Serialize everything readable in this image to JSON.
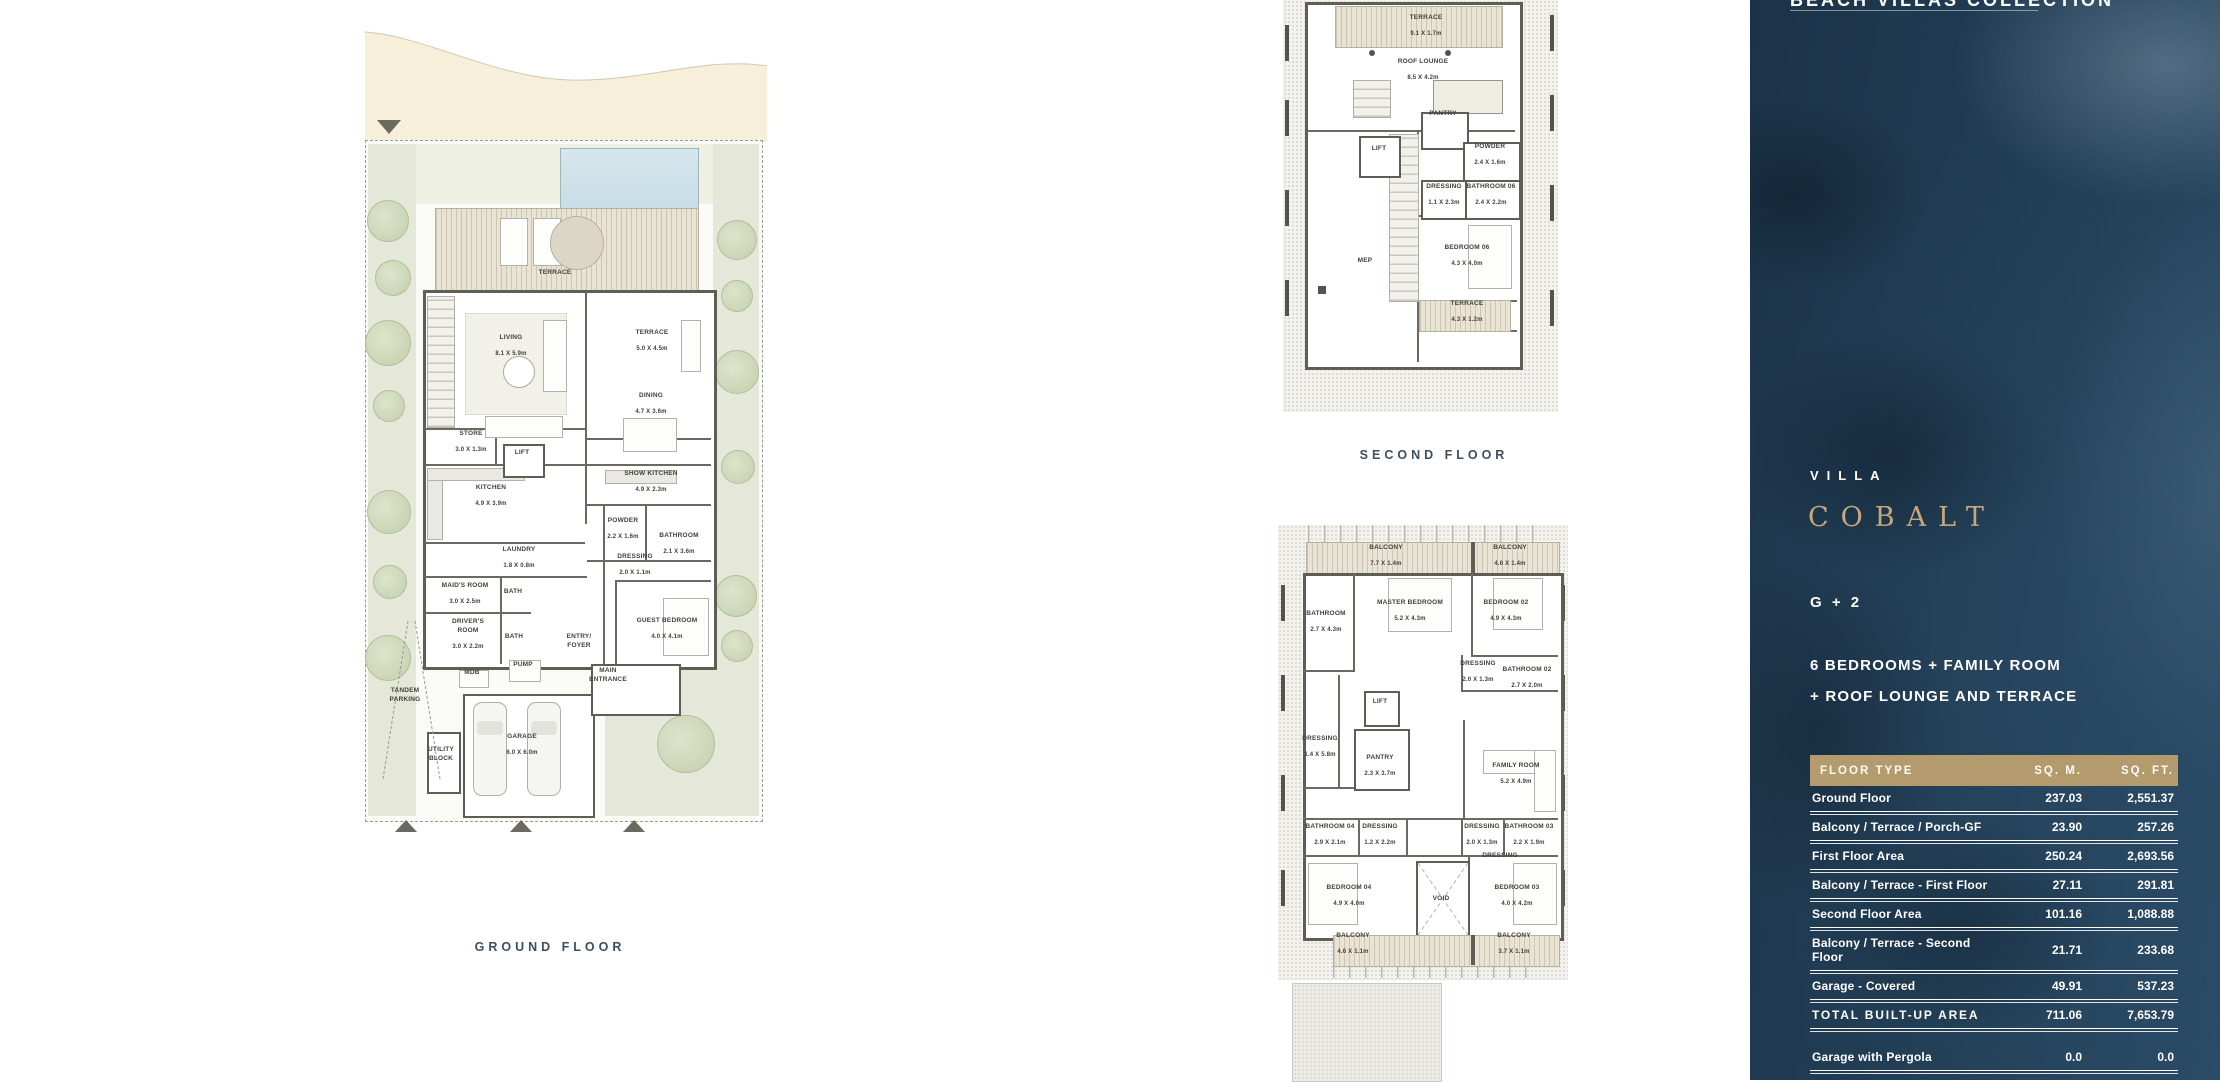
{
  "sidebar": {
    "header": "BEACH VILLAS COLLECTION",
    "villa_label": "VILLA",
    "villa_name": "COBALT",
    "storeys": "G + 2",
    "description_line1": "6 BEDROOMS + FAMILY ROOM",
    "description_line2": "+ ROOF LOUNGE AND TERRACE",
    "colors": {
      "sidebar_background": "#1f3850",
      "accent_gold": "#c6a87c",
      "table_header_background": "#b39b6d",
      "text": "#ffffff",
      "plan_wall": "#5f5e55",
      "floor_title_text": "#3d4e63"
    },
    "area_table": {
      "columns": [
        "FLOOR TYPE",
        "SQ. M.",
        "SQ. FT."
      ],
      "rows": [
        {
          "label": "Ground Floor",
          "sqm": "237.03",
          "sqft": "2,551.37"
        },
        {
          "label": "Balcony / Terrace / Porch-GF",
          "sqm": "23.90",
          "sqft": "257.26"
        },
        {
          "label": "First Floor Area",
          "sqm": "250.24",
          "sqft": "2,693.56"
        },
        {
          "label": "Balcony / Terrace - First Floor",
          "sqm": "27.11",
          "sqft": "291.81"
        },
        {
          "label": "Second Floor Area",
          "sqm": "101.16",
          "sqft": "1,088.88"
        },
        {
          "label": "Balcony / Terrace - Second Floor",
          "sqm": "21.71",
          "sqft": "233.68"
        },
        {
          "label": "Garage - Covered",
          "sqm": "49.91",
          "sqft": "537.23"
        },
        {
          "label": "TOTAL BUILT-UP AREA",
          "sqm": "711.06",
          "sqft": "7,653.79",
          "emphasis": true
        }
      ],
      "extra_rows": [
        {
          "label": "Garage with Pergola",
          "sqm": "0.0",
          "sqft": "0.0"
        },
        {
          "label": "TOTAL AREA",
          "sqm": "711.06",
          "sqft": "7,653.79",
          "emphasis": true
        }
      ]
    }
  },
  "plans": {
    "ground_floor": {
      "title": "GROUND FLOOR",
      "rooms": [
        {
          "label": "TERRACE",
          "x": 190,
          "y": 258
        },
        {
          "label": "LIVING",
          "dims": "8.1 X 5.9m",
          "x": 146,
          "y": 327
        },
        {
          "label": "TERRACE",
          "dims": "5.0 X 4.5m",
          "x": 287,
          "y": 322
        },
        {
          "label": "DINING",
          "dims": "4.7 X 3.6m",
          "x": 286,
          "y": 385
        },
        {
          "label": "STORE",
          "dims": "3.0 X 1.3m",
          "x": 106,
          "y": 423
        },
        {
          "label": "LIFT",
          "x": 157,
          "y": 438
        },
        {
          "label": "KITCHEN",
          "dims": "4.9 X 3.9m",
          "x": 126,
          "y": 477
        },
        {
          "label": "SHOW KITCHEN",
          "dims": "4.9 X 2.3m",
          "x": 286,
          "y": 463
        },
        {
          "label": "POWDER",
          "dims": "2.2 X 1.6m",
          "x": 258,
          "y": 510
        },
        {
          "label": "BATHROOM",
          "dims": "2.1 X 3.6m",
          "x": 314,
          "y": 525
        },
        {
          "label": "LAUNDRY",
          "dims": "1.8 X 0.8m",
          "x": 154,
          "y": 539
        },
        {
          "label": "DRESSING",
          "dims": "2.0 X 1.1m",
          "x": 270,
          "y": 546
        },
        {
          "label": "MAID'S ROOM",
          "dims": "3.0 X 2.5m",
          "x": 100,
          "y": 575
        },
        {
          "label": "BATH",
          "x": 148,
          "y": 577
        },
        {
          "label": "GUEST BEDROOM",
          "dims": "4.0 X 4.1m",
          "x": 302,
          "y": 610
        },
        {
          "label": "DRIVER'S\nROOM",
          "dims": "3.0 X 2.2m",
          "x": 103,
          "y": 615
        },
        {
          "label": "BATH",
          "x": 149,
          "y": 622
        },
        {
          "label": "ENTRY/\nFOYER",
          "x": 214,
          "y": 626
        },
        {
          "label": "PUMP",
          "x": 158,
          "y": 650
        },
        {
          "label": "MDB",
          "x": 107,
          "y": 658
        },
        {
          "label": "MAIN\nENTRANCE",
          "x": 243,
          "y": 660
        },
        {
          "label": "TANDEM\nPARKING",
          "x": 40,
          "y": 680
        },
        {
          "label": "UTILITY\nBLOCK",
          "x": 76,
          "y": 739
        },
        {
          "label": "GARAGE",
          "dims": "6.0 X 6.0m",
          "x": 157,
          "y": 726
        }
      ]
    },
    "second_floor": {
      "title": "SECOND FLOOR",
      "rooms": [
        {
          "label": "TERRACE",
          "dims": "9.1 X 1.7m",
          "x": 143,
          "y": 27
        },
        {
          "label": "ROOF LOUNGE",
          "dims": "8.5 X 4.2m",
          "x": 140,
          "y": 71
        },
        {
          "label": "PANTRY",
          "x": 160,
          "y": 119
        },
        {
          "label": "LIFT",
          "x": 96,
          "y": 154
        },
        {
          "label": "POWDER",
          "dims": "2.4 X 1.6m",
          "x": 207,
          "y": 156
        },
        {
          "label": "DRESSING",
          "dims": "1.1 X 2.3m",
          "x": 161,
          "y": 196
        },
        {
          "label": "BATHROOM 06",
          "dims": "2.4 X 2.2m",
          "x": 208,
          "y": 196
        },
        {
          "label": "MEP",
          "x": 82,
          "y": 266
        },
        {
          "label": "BEDROOM 06",
          "dims": "4.3 X 4.0m",
          "x": 184,
          "y": 257
        },
        {
          "label": "TERRACE",
          "dims": "4.3 X 1.2m",
          "x": 184,
          "y": 313
        }
      ]
    },
    "first_floor": {
      "rooms": [
        {
          "label": "BALCONY",
          "dims": "7.7 X 1.4m",
          "x": 108,
          "y": 32
        },
        {
          "label": "BALCONY",
          "dims": "4.6 X 1.4m",
          "x": 232,
          "y": 32
        },
        {
          "label": "BATHROOM",
          "dims": "2.7 X 4.3m",
          "x": 48,
          "y": 98
        },
        {
          "label": "MASTER BEDROOM",
          "dims": "5.2 X 4.3m",
          "x": 132,
          "y": 87
        },
        {
          "label": "BEDROOM 02",
          "dims": "4.9 X 4.3m",
          "x": 228,
          "y": 87
        },
        {
          "label": "DRESSING",
          "dims": "2.0 X 1.3m",
          "x": 200,
          "y": 148
        },
        {
          "label": "BATHROOM 02",
          "dims": "2.7 X 2.0m",
          "x": 249,
          "y": 154
        },
        {
          "label": "LIFT",
          "x": 102,
          "y": 182
        },
        {
          "label": "DRESSING",
          "dims": "1.4 X 5.8m",
          "x": 42,
          "y": 223
        },
        {
          "label": "PANTRY",
          "dims": "2.3 X 3.7m",
          "x": 102,
          "y": 242
        },
        {
          "label": "FAMILY ROOM",
          "dims": "5.2 X 4.9m",
          "x": 238,
          "y": 250
        },
        {
          "label": "BATHROOM 04",
          "dims": "2.9 X 2.1m",
          "x": 52,
          "y": 311
        },
        {
          "label": "DRESSING",
          "dims": "1.2 X 2.2m",
          "x": 102,
          "y": 311
        },
        {
          "label": "DRESSING",
          "dims": "2.0 X 1.3m",
          "x": 204,
          "y": 311
        },
        {
          "label": "BATHROOM 03",
          "dims": "2.2 X 1.9m",
          "x": 251,
          "y": 311
        },
        {
          "label": "DRESSING",
          "x": 222,
          "y": 336
        },
        {
          "label": "BEDROOM 04",
          "dims": "4.9 X 4.0m",
          "x": 71,
          "y": 372
        },
        {
          "label": "VOID",
          "x": 163,
          "y": 379
        },
        {
          "label": "BEDROOM 03",
          "dims": "4.0 X 4.2m",
          "x": 239,
          "y": 372
        },
        {
          "label": "BALCONY",
          "dims": "4.6 X 1.1m",
          "x": 75,
          "y": 420
        },
        {
          "label": "BALCONY",
          "dims": "3.7 X 1.1m",
          "x": 236,
          "y": 420
        }
      ]
    }
  }
}
